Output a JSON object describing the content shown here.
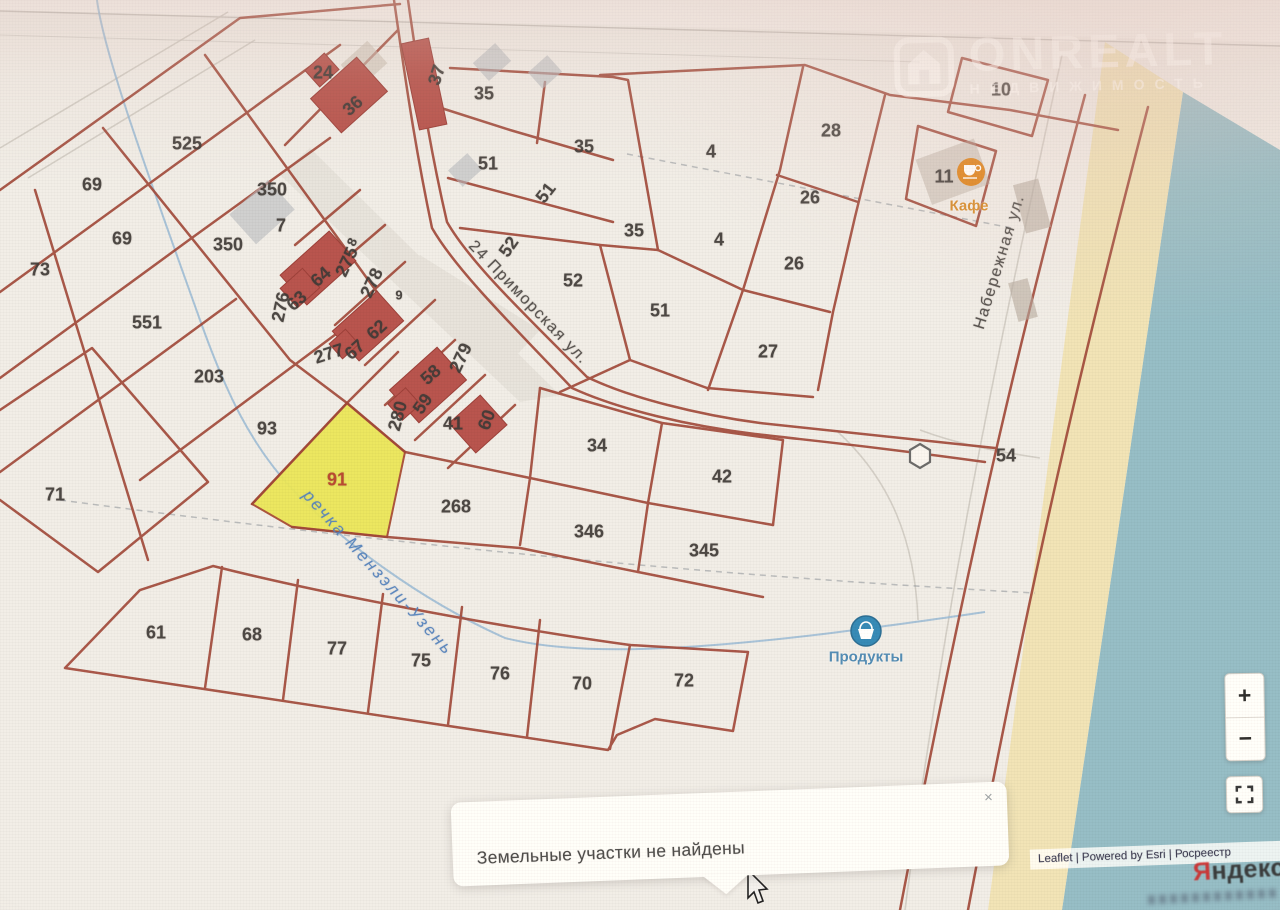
{
  "watermark": {
    "brand": "ONREALT",
    "subtitle": "НЕДВИЖИМОСТЬ"
  },
  "popup": {
    "message": "Земельные участки не найдены",
    "close": "×"
  },
  "attribution": {
    "text": "Leaflet | Powered by Esri | Росреестр",
    "yandex_ya": "Я",
    "yandex_rest": "ндекс"
  },
  "controls": {
    "zoom_in": "+",
    "zoom_out": "−"
  },
  "colors": {
    "parcel_line": "#a84434",
    "highlight_parcel": "#e9e64a",
    "water": "#8fbdc9",
    "beach": "#eedfae",
    "cafe_marker": "#e8830f",
    "shop_marker": "#2b8cbf",
    "river_text": "#4b80c4",
    "yandex_red": "#e02020"
  },
  "map": {
    "highlighted_parcel": "91",
    "markers": {
      "cafe": "Кафе",
      "shop": "Продукты"
    },
    "streets": [
      "24 Приморская ул.",
      "Набережная ул."
    ],
    "river": "речка Мензэли-Узень",
    "labels": [
      {
        "t": "24",
        "x": 323,
        "y": 73
      },
      {
        "t": "36",
        "x": 353,
        "y": 106,
        "r": -42
      },
      {
        "t": "37",
        "x": 437,
        "y": 75,
        "r": -72
      },
      {
        "t": "35",
        "x": 484,
        "y": 94
      },
      {
        "t": "51",
        "x": 488,
        "y": 164
      },
      {
        "t": "35",
        "x": 584,
        "y": 147
      },
      {
        "t": "51",
        "x": 546,
        "y": 193,
        "r": -52
      },
      {
        "t": "52",
        "x": 509,
        "y": 247,
        "r": -55
      },
      {
        "t": "52",
        "x": 573,
        "y": 281
      },
      {
        "t": "35",
        "x": 634,
        "y": 231
      },
      {
        "t": "4",
        "x": 711,
        "y": 152
      },
      {
        "t": "28",
        "x": 831,
        "y": 131
      },
      {
        "t": "26",
        "x": 810,
        "y": 198
      },
      {
        "t": "26",
        "x": 794,
        "y": 264
      },
      {
        "t": "4",
        "x": 719,
        "y": 240
      },
      {
        "t": "51",
        "x": 660,
        "y": 311
      },
      {
        "t": "27",
        "x": 768,
        "y": 352
      },
      {
        "t": "10",
        "x": 1001,
        "y": 90
      },
      {
        "t": "11",
        "x": 944,
        "y": 177
      },
      {
        "t": "54",
        "x": 1006,
        "y": 456
      },
      {
        "t": "525",
        "x": 187,
        "y": 144
      },
      {
        "t": "69",
        "x": 92,
        "y": 185
      },
      {
        "t": "69",
        "x": 122,
        "y": 239
      },
      {
        "t": "73",
        "x": 40,
        "y": 270
      },
      {
        "t": "350",
        "x": 272,
        "y": 190
      },
      {
        "t": "7",
        "x": 281,
        "y": 226
      },
      {
        "t": "350",
        "x": 228,
        "y": 245
      },
      {
        "t": "551",
        "x": 147,
        "y": 323
      },
      {
        "t": "203",
        "x": 209,
        "y": 377
      },
      {
        "t": "93",
        "x": 267,
        "y": 429
      },
      {
        "t": "71",
        "x": 55,
        "y": 495
      },
      {
        "t": "8",
        "x": 352,
        "y": 242,
        "r": -65,
        "cls": "small"
      },
      {
        "t": "275",
        "x": 347,
        "y": 262,
        "r": -65
      },
      {
        "t": "64",
        "x": 321,
        "y": 277,
        "r": -42
      },
      {
        "t": "63",
        "x": 297,
        "y": 301,
        "r": -42
      },
      {
        "t": "276",
        "x": 281,
        "y": 307,
        "r": -78
      },
      {
        "t": "278",
        "x": 372,
        "y": 283,
        "r": -65
      },
      {
        "t": "9",
        "x": 399,
        "y": 295,
        "cls": "small"
      },
      {
        "t": "62",
        "x": 377,
        "y": 330,
        "r": -42
      },
      {
        "t": "277",
        "x": 329,
        "y": 354,
        "r": -18
      },
      {
        "t": "67",
        "x": 355,
        "y": 350,
        "r": -42
      },
      {
        "t": "279",
        "x": 461,
        "y": 358,
        "r": -65
      },
      {
        "t": "58",
        "x": 431,
        "y": 375,
        "r": -42
      },
      {
        "t": "59",
        "x": 423,
        "y": 404,
        "r": -55
      },
      {
        "t": "280",
        "x": 398,
        "y": 416,
        "r": -75
      },
      {
        "t": "41",
        "x": 453,
        "y": 424
      },
      {
        "t": "60",
        "x": 487,
        "y": 420,
        "r": -70
      },
      {
        "t": "91",
        "x": 337,
        "y": 480,
        "cls": "red"
      },
      {
        "t": "268",
        "x": 456,
        "y": 507
      },
      {
        "t": "34",
        "x": 597,
        "y": 446
      },
      {
        "t": "42",
        "x": 722,
        "y": 477
      },
      {
        "t": "346",
        "x": 589,
        "y": 532
      },
      {
        "t": "345",
        "x": 704,
        "y": 551
      },
      {
        "t": "61",
        "x": 156,
        "y": 633
      },
      {
        "t": "68",
        "x": 252,
        "y": 635
      },
      {
        "t": "77",
        "x": 337,
        "y": 649
      },
      {
        "t": "75",
        "x": 421,
        "y": 661
      },
      {
        "t": "76",
        "x": 500,
        "y": 674
      },
      {
        "t": "70",
        "x": 582,
        "y": 684
      },
      {
        "t": "72",
        "x": 684,
        "y": 681
      },
      {
        "t": "24 Приморская ул.",
        "x": 528,
        "y": 303,
        "r": 46,
        "cls": "street"
      },
      {
        "t": "Набережная ул.",
        "x": 1000,
        "y": 262,
        "r": -73,
        "cls": "street"
      },
      {
        "t": "речка Мензэли-Узень",
        "x": 378,
        "y": 573,
        "r": 48,
        "cls": "river"
      },
      {
        "t": "Кафе",
        "x": 969,
        "y": 206,
        "cls": "cafe"
      },
      {
        "t": "Продукты",
        "x": 866,
        "y": 657,
        "cls": "shop"
      }
    ]
  }
}
